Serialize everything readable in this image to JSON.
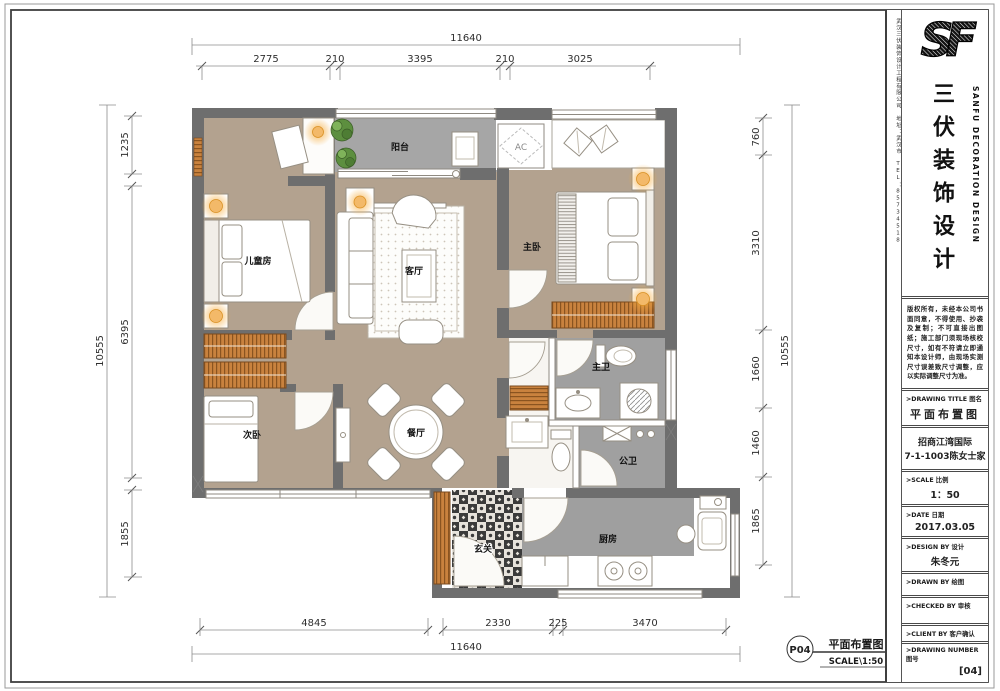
{
  "dimensions": {
    "top": {
      "total": "11640",
      "segments": [
        "2775",
        "210",
        "3395",
        "210",
        "3025"
      ]
    },
    "bottom": {
      "total": "11640",
      "segments": [
        "4845",
        "2330",
        "225",
        "3470"
      ]
    },
    "left": {
      "total": "10555",
      "segments": [
        "1235",
        "6395",
        "1855"
      ]
    },
    "right": {
      "total": "10555",
      "segments": [
        "760",
        "3310",
        "1660",
        "1460",
        "1865"
      ]
    }
  },
  "rooms": {
    "children": "儿童房",
    "balcony": "阳台",
    "living": "客厅",
    "master": "主卧",
    "second": "次卧",
    "dining": "餐厅",
    "master_bath": "主卫",
    "guest_bath": "公卫",
    "kitchen": "厨房",
    "entry": "玄关",
    "ac": "AC"
  },
  "stamp": {
    "number": "P04",
    "title": "平面布置图",
    "scale": "SCALE\\1:50"
  },
  "title_block": {
    "company_strip": "武汉三伏装饰设计工程有限公司　地址：武汉市　TEL：85734518",
    "brand_cn": "三伏装饰设计",
    "brand_en": "SANFU DECORATION DESIGN",
    "copyright": "版权所有，未经本公司书面同意，不得使用、抄袭及复制；不可直接出图纸；施工部门须现场核校尺寸，如有不符请立即通知本设计师，由现场实测尺寸误差致尺寸调整，应以实际调整尺寸为准。",
    "drawing_title_label": ">DRAWING TITLE 图名",
    "drawing_title": "平面布置图",
    "project_line1": "招商江湾国际",
    "project_line2": "7-1-1003陈女士家",
    "scale_label": ">SCALE 比例",
    "scale_value": "1：50",
    "date_label": ">DATE 日期",
    "date_value": "2017.03.05",
    "design_label": ">DESIGN BY 设计",
    "design_value": "朱冬元",
    "drawn_label": ">DRAWN BY 绘图",
    "checked_label": ">CHECKED BY 审核",
    "client_label": ">CLIENT BY 客户确认",
    "number_label": ">DRAWING NUMBER 图号",
    "number_value": "[04]"
  }
}
